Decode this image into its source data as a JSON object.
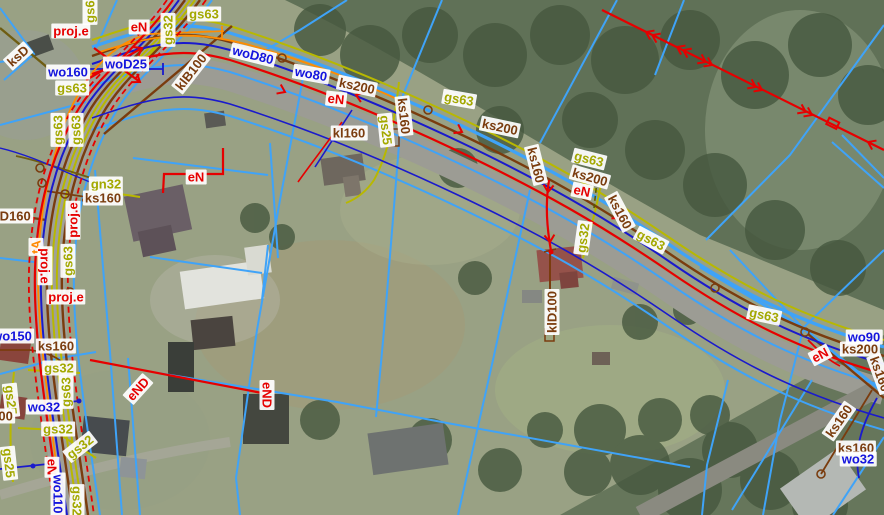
{
  "map": {
    "description": "orthophoto with cadastral parcels and utility network overlay",
    "legend_colors": {
      "water": "#1414dd",
      "sewer": "#7a3c0e",
      "gas": "#a3a800",
      "power": "#e60000",
      "telecom": "#ff8800",
      "parcel": "#3fa3f8"
    },
    "labels": [
      {
        "t": "gs63",
        "x": 90,
        "y": 8,
        "r": -90,
        "c": "g"
      },
      {
        "t": "proj.e",
        "x": 71,
        "y": 31,
        "r": 0,
        "c": "e"
      },
      {
        "t": "eN",
        "x": 139,
        "y": 27,
        "r": 0,
        "c": "e"
      },
      {
        "t": "gs32",
        "x": 168,
        "y": 30,
        "r": -90,
        "c": "g"
      },
      {
        "t": "gs63",
        "x": 204,
        "y": 14,
        "r": 0,
        "c": "g"
      },
      {
        "t": "ksD",
        "x": 18,
        "y": 56,
        "r": -42,
        "c": "s"
      },
      {
        "t": "woD80",
        "x": 253,
        "y": 55,
        "r": 14,
        "c": "w"
      },
      {
        "t": "wo160",
        "x": 68,
        "y": 72,
        "r": 0,
        "c": "w"
      },
      {
        "t": "woD25",
        "x": 126,
        "y": 64,
        "r": 0,
        "c": "w"
      },
      {
        "t": "klB100",
        "x": 191,
        "y": 72,
        "r": -52,
        "c": "s"
      },
      {
        "t": "gs63",
        "x": 72,
        "y": 88,
        "r": 0,
        "c": "g"
      },
      {
        "t": "gs63",
        "x": 58,
        "y": 130,
        "r": -90,
        "c": "g"
      },
      {
        "t": "gs63",
        "x": 76,
        "y": 130,
        "r": -90,
        "c": "g"
      },
      {
        "t": "wo80",
        "x": 311,
        "y": 74,
        "r": 10,
        "c": "w"
      },
      {
        "t": "ks200",
        "x": 357,
        "y": 86,
        "r": 12,
        "c": "s"
      },
      {
        "t": "eN",
        "x": 336,
        "y": 99,
        "r": 6,
        "c": "e"
      },
      {
        "t": "ks200",
        "x": 500,
        "y": 127,
        "r": 12,
        "c": "s"
      },
      {
        "t": "ks160",
        "x": 404,
        "y": 116,
        "r": 84,
        "c": "s"
      },
      {
        "t": "gs25",
        "x": 386,
        "y": 130,
        "r": 84,
        "c": "g"
      },
      {
        "t": "kl160",
        "x": 349,
        "y": 133,
        "r": 0,
        "c": "s"
      },
      {
        "t": "gs63",
        "x": 459,
        "y": 99,
        "r": 10,
        "c": "g"
      },
      {
        "t": "gs63",
        "x": 589,
        "y": 159,
        "r": 14,
        "c": "g"
      },
      {
        "t": "ks200",
        "x": 590,
        "y": 177,
        "r": 16,
        "c": "s"
      },
      {
        "t": "eN",
        "x": 582,
        "y": 191,
        "r": 12,
        "c": "e"
      },
      {
        "t": "ks160",
        "x": 536,
        "y": 165,
        "r": 76,
        "c": "s"
      },
      {
        "t": "ks160",
        "x": 620,
        "y": 212,
        "r": 62,
        "c": "s"
      },
      {
        "t": "gs32",
        "x": 583,
        "y": 238,
        "r": -82,
        "c": "g"
      },
      {
        "t": "gs63",
        "x": 651,
        "y": 240,
        "r": 28,
        "c": "g"
      },
      {
        "t": "gs63",
        "x": 764,
        "y": 315,
        "r": 12,
        "c": "g"
      },
      {
        "t": "klD100",
        "x": 552,
        "y": 312,
        "r": -90,
        "c": "s"
      },
      {
        "t": "gn32",
        "x": 106,
        "y": 184,
        "r": 0,
        "c": "g"
      },
      {
        "t": "ks160",
        "x": 103,
        "y": 198,
        "r": 0,
        "c": "s"
      },
      {
        "t": "eN",
        "x": 196,
        "y": 177,
        "r": 0,
        "c": "e"
      },
      {
        "t": "ksD160",
        "x": 8,
        "y": 216,
        "r": 0,
        "c": "s"
      },
      {
        "t": "proj.e",
        "x": 73,
        "y": 220,
        "r": -90,
        "c": "e"
      },
      {
        "t": "tA",
        "x": 36,
        "y": 247,
        "r": -90,
        "c": "t"
      },
      {
        "t": "proj.e",
        "x": 45,
        "y": 266,
        "r": 90,
        "c": "e"
      },
      {
        "t": "gs63",
        "x": 68,
        "y": 261,
        "r": -90,
        "c": "g"
      },
      {
        "t": "proj.e",
        "x": 66,
        "y": 297,
        "r": 0,
        "c": "e"
      },
      {
        "t": "wo150",
        "x": 12,
        "y": 336,
        "r": 0,
        "c": "w"
      },
      {
        "t": "ks160",
        "x": 56,
        "y": 346,
        "r": 0,
        "c": "s"
      },
      {
        "t": "gs32",
        "x": 59,
        "y": 368,
        "r": 0,
        "c": "g"
      },
      {
        "t": "gs63",
        "x": 66,
        "y": 392,
        "r": -90,
        "c": "g"
      },
      {
        "t": "gs25",
        "x": 11,
        "y": 400,
        "r": 84,
        "c": "g"
      },
      {
        "t": "100",
        "x": 2,
        "y": 416,
        "r": 0,
        "c": "s"
      },
      {
        "t": "wo32",
        "x": 44,
        "y": 407,
        "r": 0,
        "c": "w"
      },
      {
        "t": "eND",
        "x": 138,
        "y": 389,
        "r": -48,
        "c": "e"
      },
      {
        "t": "eND",
        "x": 267,
        "y": 395,
        "r": 90,
        "c": "e"
      },
      {
        "t": "gs32",
        "x": 58,
        "y": 429,
        "r": 0,
        "c": "g"
      },
      {
        "t": "gs32",
        "x": 80,
        "y": 447,
        "r": -38,
        "c": "g"
      },
      {
        "t": "gs25",
        "x": 9,
        "y": 463,
        "r": 84,
        "c": "g"
      },
      {
        "t": "eN",
        "x": 52,
        "y": 467,
        "r": 90,
        "c": "e"
      },
      {
        "t": "wo110",
        "x": 58,
        "y": 494,
        "r": 90,
        "c": "w"
      },
      {
        "t": "gs32",
        "x": 77,
        "y": 501,
        "r": 90,
        "c": "g"
      },
      {
        "t": "wo90",
        "x": 864,
        "y": 337,
        "r": 0,
        "c": "w"
      },
      {
        "t": "ks200",
        "x": 860,
        "y": 349,
        "r": 0,
        "c": "s"
      },
      {
        "t": "eN",
        "x": 820,
        "y": 355,
        "r": -28,
        "c": "e"
      },
      {
        "t": "ks160",
        "x": 880,
        "y": 374,
        "r": 70,
        "c": "s"
      },
      {
        "t": "ks160",
        "x": 839,
        "y": 421,
        "r": -55,
        "c": "s"
      },
      {
        "t": "ks160",
        "x": 856,
        "y": 448,
        "r": 0,
        "c": "s"
      },
      {
        "t": "wo32",
        "x": 858,
        "y": 459,
        "r": 0,
        "c": "w"
      }
    ]
  }
}
